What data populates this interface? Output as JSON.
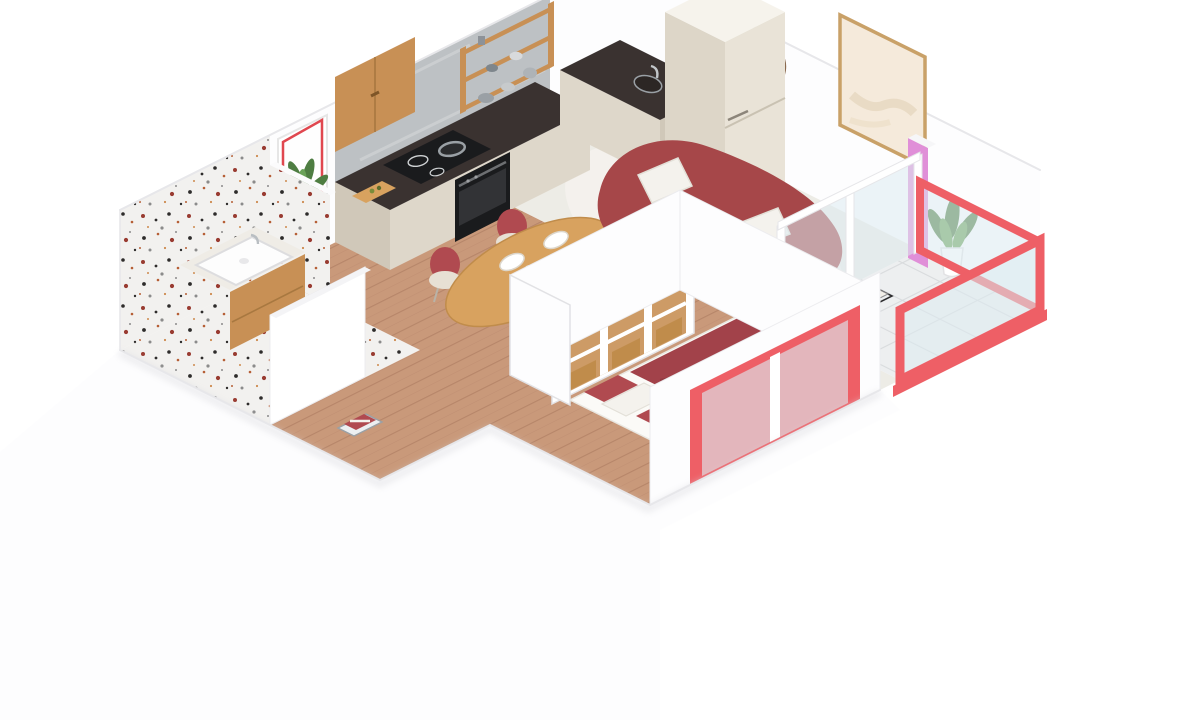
{
  "image": {
    "kind": "isometric-3d-floor-plan-render",
    "width_px": 1200,
    "height_px": 720
  },
  "palette": {
    "bg": "#ffffff",
    "wall-white": "#fdfdfe",
    "wall-shade": "#f1f1f4",
    "wall-edge": "#e7e7ea",
    "shadow": "#d9d9de",
    "terrazzo-base": "#f2f1ef",
    "speck-black": "#2e2c2b",
    "speck-rust": "#b65f36",
    "speck-maroon": "#993b31",
    "speck-gray": "#8b8b8b",
    "speck-orange": "#cd8a4e",
    "wood-floor": "#c9997a",
    "wood-floor-line": "#b7866a",
    "wood-mid": "#d8a25f",
    "wood-deep": "#c08c4b",
    "cabinet-wood": "#c89055",
    "counter-dark": "#3a3230",
    "appliance-black": "#1a1b1d",
    "backsplash-gray": "#bdc1c4",
    "backsplash-vein": "#d4d7d9",
    "cream-cabinet": "#ded7ca",
    "cream-cabinet-shade": "#d0c8b9",
    "fridge-cream": "#e9e3d7",
    "fridge-side": "#ddd6c8",
    "sofa-red": "#a64749",
    "sofa-red-deep": "#92393e",
    "duvet-red": "#a2424a",
    "chair-red": "#b04a50",
    "coral": "#ee5f66",
    "coral-deep": "#e0474f",
    "pink-accent": "#e08fd8",
    "carpet-cream": "#edece6",
    "rug-dark": "#59564f",
    "tile-light": "#edeff0",
    "tile-line": "#d9dcde",
    "glass": "#dcebf0",
    "plant-green": "#4e7d42",
    "plant-green-light": "#6aa258",
    "basin-white": "#fdfdfd",
    "pillow-white": "#f4f2ed",
    "steel": "#9aa0a5",
    "frame-wood": "#c9a168",
    "art-paper": "#f5eadb"
  },
  "scene": {
    "rooms": [
      {
        "name": "bathroom",
        "floor": "terrazzo",
        "features": [
          "terrazzo-wall",
          "vanity-sink",
          "plant",
          "towel-basket"
        ]
      },
      {
        "name": "kitchen",
        "floor": "wood",
        "features": [
          "dark-marble-counter",
          "induction-cooktop",
          "oven",
          "upper-cabinet",
          "open-shelves",
          "fridge",
          "sink",
          "red-framed-window"
        ]
      },
      {
        "name": "dining-area",
        "floor": "wood",
        "features": [
          "oval-wood-table",
          "four-chairs",
          "place-settings"
        ]
      },
      {
        "name": "living-room",
        "floor": "carpet",
        "features": [
          "curved-red-sofa",
          "white-pillows",
          "coffee-table",
          "dark-rug",
          "wall-art",
          "wall-decor-circle",
          "pink-accent-pillar",
          "potted-plant"
        ]
      },
      {
        "name": "bedroom",
        "floor": "wood",
        "features": [
          "bed-red-duvet",
          "open-wardrobe",
          "open-door",
          "coral-window"
        ]
      },
      {
        "name": "balcony",
        "floor": "marble-tile",
        "features": [
          "coral-glass-parapet",
          "glass-partition"
        ]
      }
    ]
  }
}
